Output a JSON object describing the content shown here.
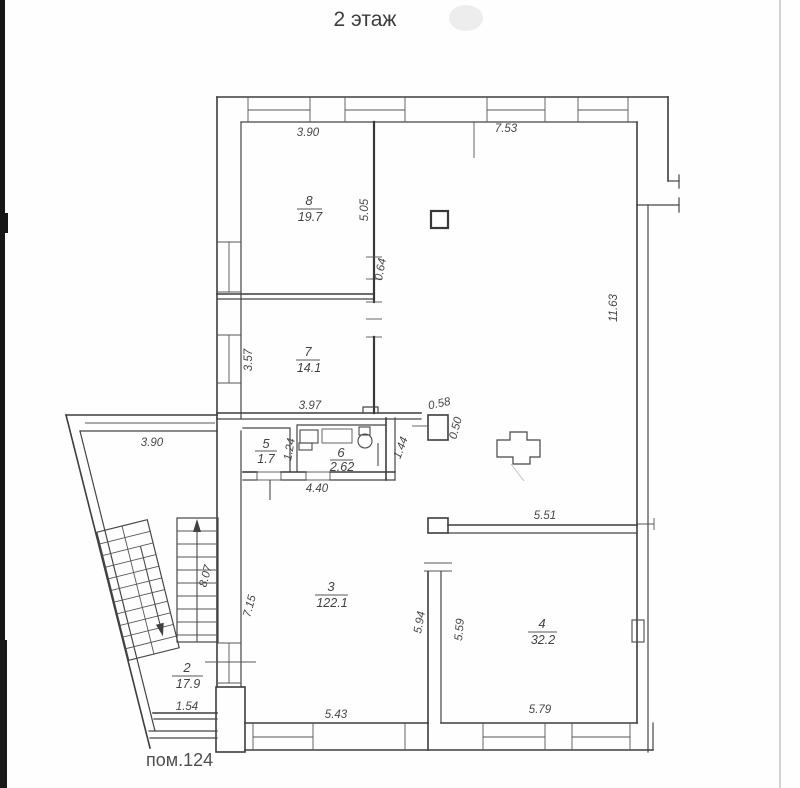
{
  "title": "2 этаж",
  "footer_label": "пом.124",
  "rooms": {
    "r8": {
      "number": "8",
      "area": "19.7"
    },
    "r7": {
      "number": "7",
      "area": "14.1"
    },
    "r5": {
      "number": "5",
      "area": "1.7"
    },
    "r6": {
      "number": "6",
      "area": "2.62"
    },
    "r3": {
      "number": "3",
      "area": "122.1"
    },
    "r4": {
      "number": "4",
      "area": "32.2"
    },
    "r2": {
      "number": "2",
      "area": "17.9"
    }
  },
  "dimensions": {
    "top_left": "3.90",
    "top_right": "7.53",
    "room8_depth": "5.05",
    "pier": "0.64",
    "room7_left": "3.57",
    "room7_bottom": "3.97",
    "column_width": "0.58",
    "column_height": "0.50",
    "room6_left": "1.24",
    "hall_wall": "1.44",
    "corridor_bottom": "4.40",
    "east_wall": "11.63",
    "room4_top": "5.51",
    "room4_left": "5.59",
    "room3_right": "5.94",
    "room3_left": "7.15",
    "stairs": "8.07",
    "bottom_left": "5.43",
    "bottom_right": "5.79",
    "wing_top": "3.90",
    "room2_bottom": "1.54"
  },
  "colors": {
    "ink": "#3d3d3d",
    "label": "#474747",
    "paper": "#fefefe"
  }
}
